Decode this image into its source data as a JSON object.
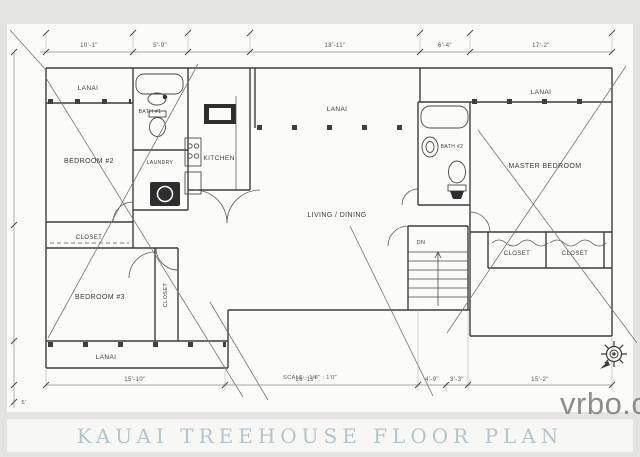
{
  "title": "KAUAI TREEHOUSE FLOOR PLAN",
  "watermark": "vrbo.com",
  "scale_note": "SCALE - 1/8\" : 1'0\"",
  "rooms": {
    "lanai_top_left": "LANAI",
    "bedroom_2": "BEDROOM #2",
    "bath_1": "BATH #1",
    "laundry": "LAUNDRY",
    "kitchen": "KITCHEN",
    "lanai_center": "LANAI",
    "living_dining": "LIVING / DINING",
    "lanai_top_right": "LANAI",
    "bath_2": "BATH #2",
    "master_bedroom": "MASTER BEDROOM",
    "stairs_down": "DN",
    "closet_hall_1": "CLOSET",
    "closet_hall_2": "CLOSET",
    "closet_bedroom_3_top": "CLOSET",
    "bedroom_3": "BEDROOM #3",
    "closet_bedroom_3_side": "CLOSET",
    "lanai_bottom": "LANAI"
  },
  "dimensions": {
    "top": [
      "10'-1\"",
      "5'-9\"",
      "18'-11\"",
      "6'-4\"",
      "17'-2\""
    ],
    "bottom": [
      "15'-10\"",
      "26'-11\"",
      "4'-9\"",
      "3'-3\"",
      "15'-2\""
    ],
    "left_corner": "5'"
  },
  "colors": {
    "wall_line": "#3d3d3d",
    "dimension_line": "#8a8a8a",
    "paper": "#fbfbfa",
    "mat": "#e4e4e2",
    "title_text": "#b5c4ca",
    "watermark_text": "#8d8d8d"
  }
}
